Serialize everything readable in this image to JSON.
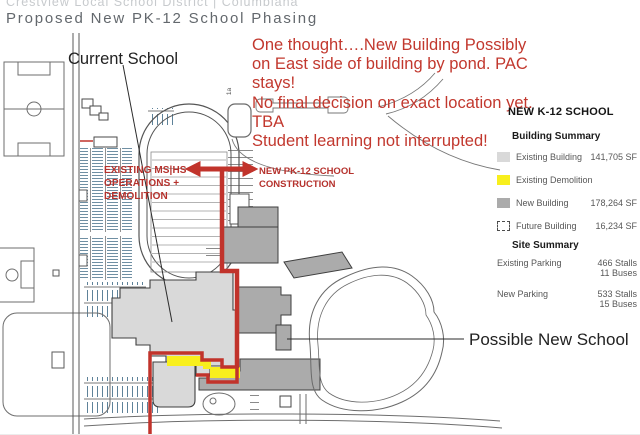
{
  "header": {
    "subtitle": "Crestview Local School District | Columbiana",
    "title": "Proposed New PK-12 School Phasing"
  },
  "annotation": {
    "color": "#c2382e",
    "lines": [
      "One thought….New Building Possibly",
      "on East side of building by pond. PAC",
      "stays!",
      "No final decision on exact location yet.",
      "TBA",
      "Student learning not interrupted!"
    ]
  },
  "map": {
    "labels": {
      "current_school": "Current School",
      "possible_new_school": "Possible New School",
      "existing_ops": [
        "EXISTING MS|HS",
        "OPERATIONS +",
        "DEMOLITION"
      ],
      "new_construction": [
        "NEW PK-12 SCHOOL",
        "CONSTRUCTION"
      ],
      "parcel": "1a"
    },
    "colors": {
      "existing_building": "#d9d9d9",
      "new_building": "#ababab",
      "demolition": "#f8ef1d",
      "route_red": "#c1332b"
    }
  },
  "legend": {
    "title": "NEW K-12 SCHOOL",
    "building_summary": {
      "title": "Building Summary",
      "rows": [
        {
          "label": "Existing Building",
          "value": "141,705 SF"
        },
        {
          "label": "Existing Demolition",
          "value": ""
        },
        {
          "label": "New Building",
          "value": "178,264 SF"
        },
        {
          "label": "Future Building",
          "value": "16,234 SF"
        }
      ]
    },
    "site_summary": {
      "title": "Site Summary",
      "rows": [
        {
          "label": "Existing Parking",
          "values": [
            "466 Stalls",
            "11 Buses"
          ]
        },
        {
          "label": "New Parking",
          "values": [
            "533 Stalls",
            "15 Buses"
          ]
        }
      ]
    }
  }
}
